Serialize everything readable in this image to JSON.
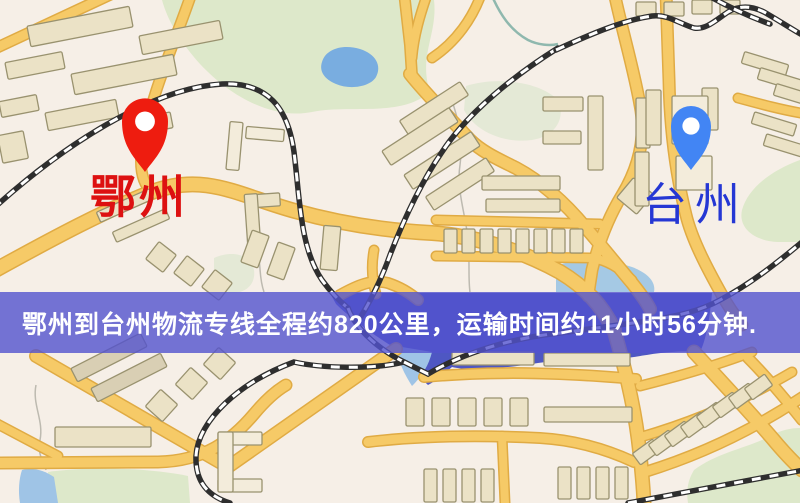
{
  "banner": {
    "text": "鄂州到台州物流专线全程约820公里，运输时间约11小时56分钟.",
    "bg": "rgba(82,82,206,0.8)",
    "text_color": "#ffffff",
    "top": 292,
    "height": 61
  },
  "origin": {
    "name": "鄂州",
    "pin_color": "#ee1c0f",
    "label_color": "#dd1111",
    "pin_x": 145,
    "pin_tip_y": 172,
    "pin_r": 23,
    "label_left": 90,
    "label_top": 174,
    "font_size": 46,
    "font_weight": 700,
    "letter_spacing": 3
  },
  "destination": {
    "name": "台州",
    "pin_color": "#4285f4",
    "label_color": "#2537d4",
    "pin_x": 691,
    "pin_tip_y": 170,
    "pin_r": 20,
    "label_left": 642,
    "label_top": 182,
    "font_size": 45,
    "font_weight": 400,
    "letter_spacing": 8
  },
  "map": {
    "width": 800,
    "height": 503,
    "bg": "#f6efe7",
    "palette": {
      "park": "#dde8ca",
      "park_muted": "#e4e9d6",
      "pond": "#79ade0",
      "lake": "#4e57c3",
      "water_light": "#9fc4e6",
      "water_pale": "#a5c9e4",
      "road_casing": "#e0ab44",
      "road_fill": "#f6ca67",
      "rail": "#2e2e2e",
      "rail_dash": "#ffffff",
      "bld": "#ebe2c6",
      "bld_stroke": "#99926f",
      "lt": "#f3ecdb",
      "hatch": "#d9cfb4",
      "stream": "#bdbab0",
      "stream_teal": "#8fb8ae"
    },
    "parks": [
      {
        "d": "M162,0 L434,0 C438,34 418,56 430,92 C400,118 350,104 312,112 C272,120 230,96 200,64 C182,44 168,22 162,0 Z",
        "f": "park"
      },
      {
        "d": "M800,160 C772,170 748,188 742,210 C738,228 754,241 778,242 L800,242 Z",
        "f": "park"
      },
      {
        "d": "M694,470 C718,452 748,448 770,436 C781,430 791,428 800,428 L800,503 L688,503 C686,490 688,480 694,470 Z",
        "f": "park"
      },
      {
        "d": "M48,472 C90,466 150,468 188,476 L190,503 L50,503 Z",
        "f": "park"
      },
      {
        "d": "M466,86 C498,76 540,82 558,100 C566,118 556,136 532,140 C502,144 474,130 464,110 Z",
        "f": "park_muted"
      },
      {
        "d": "M214,258 C232,250 250,254 254,270 C256,284 246,293 232,293 L214,293 Z",
        "f": "park_muted"
      }
    ],
    "water": [
      {
        "d": "M322,62 C326,48 344,44 360,49 C376,54 382,66 376,77 C370,87 350,90 336,84 C324,79 319,71 322,62 Z",
        "f": "pond"
      },
      {
        "d": "M330,293 L712,293 C710,318 706,340 700,352 C670,350 648,355 634,357 C598,362 564,359 538,363 C500,369 468,371 452,367 C444,374 436,381 428,385 C416,374 404,360 398,350 C378,338 350,318 336,304 Z",
        "f": "lake"
      },
      {
        "d": "M396,346 L432,352 C428,368 420,378 412,386 C403,372 397,358 396,346 Z",
        "f": "water_light"
      },
      {
        "d": "M22,470 C32,467 44,470 54,477 L58,503 L20,503 C18,491 19,479 22,470 Z",
        "f": "water_light"
      },
      {
        "d": "M556,266 C578,257 608,259 632,267 C648,273 656,282 654,292 L556,292 Z",
        "f": "water_pale"
      }
    ],
    "streams": [
      {
        "d": "M450,94 C458,120 464,135 460,165 C456,190 466,215 468,240 C470,262 468,278 470,292",
        "c": "stream",
        "w": 1.5
      },
      {
        "d": "M256,250 C262,262 258,275 264,292",
        "c": "stream",
        "w": 1.5
      },
      {
        "d": "M36,385 C32,405 44,420 40,440 C37,455 44,462 46,470",
        "c": "stream",
        "w": 1.5
      },
      {
        "d": "M492,-4 C500,14 510,30 528,40 C538,45 550,46 558,44",
        "c": "stream_teal",
        "w": 2.5
      }
    ],
    "roads": [
      {
        "d": "M-8,50 L116,-8",
        "w": 9
      },
      {
        "d": "M192,-8 C176,40 150,95 142,148 C139,170 143,184 152,192",
        "w": 9
      },
      {
        "d": "M-10,273 C55,237 108,209 152,192 C205,172 240,196 295,211 C345,225 392,231 432,233 C475,236 520,250 560,272 C585,287 602,305 614,330",
        "w": 13
      },
      {
        "d": "M614,330 C624,365 633,400 638,438 C641,462 643,482 644,503",
        "w": 12
      },
      {
        "d": "M404,-8 L410,45 L412,76",
        "w": 9
      },
      {
        "d": "M428,-8 C420,15 414,35 412,58",
        "w": 8
      },
      {
        "d": "M482,-8 C473,18 456,42 432,58",
        "w": 8
      },
      {
        "d": "M410,74 C424,92 448,116 470,140 C482,152 500,160 516,168 C542,182 566,204 586,228 C600,244 616,264 632,283 C640,293 646,301 650,309",
        "w": 11
      },
      {
        "d": "M614,-8 C622,30 634,70 640,105 C646,135 640,165 622,195 C608,218 598,245 592,270 L588,296",
        "w": 10
      },
      {
        "d": "M666,-8 L669,80 C670,130 676,175 686,215 C692,240 708,270 722,295 C728,306 735,316 742,325",
        "w": 10
      },
      {
        "d": "M694,352 C720,380 748,410 772,438 C782,450 792,461 802,470",
        "w": 12
      },
      {
        "d": "M738,98 C760,104 782,110 806,114",
        "w": 8
      },
      {
        "d": "M424,377 C490,371 555,372 636,379",
        "w": 9
      },
      {
        "d": "M640,386 C688,374 720,364 752,352",
        "w": 8
      },
      {
        "d": "M641,437 C700,420 748,398 792,372",
        "w": 8
      },
      {
        "d": "M645,472 C710,452 762,424 804,396",
        "w": 9
      },
      {
        "d": "M368,442 C420,436 480,435 540,438 C575,440 608,450 634,462",
        "w": 9
      },
      {
        "d": "M36,356 L228,467 L396,349",
        "w": 11
      },
      {
        "d": "M-8,463 L158,462 C205,461 232,440 254,414 C264,402 274,392 286,385",
        "w": 10
      },
      {
        "d": "M-10,420 L58,456",
        "w": 8
      },
      {
        "d": "M502,436 L505,503",
        "w": 8
      },
      {
        "d": "M748,358 C768,378 786,400 802,420",
        "w": 9
      },
      {
        "d": "M340,295 C358,285 372,279 388,283 C400,287 410,293 418,300",
        "w": 9
      },
      {
        "d": "M374,250 C371,266 372,280 376,294",
        "w": 8
      },
      {
        "d": "M436,220 L600,224",
        "w": 8
      },
      {
        "d": "M436,256 L592,258 C606,260 620,268 632,280",
        "w": 8
      }
    ],
    "railways": [
      "M-6,208 C60,148 150,88 222,84 C268,82 288,108 294,152 C300,200 300,248 322,280 C330,291 338,300 348,308",
      "M558,48 C515,75 468,112 442,152 C420,184 402,224 390,255 C380,283 368,305 360,318",
      "M348,308 C356,330 380,350 404,362 C372,370 320,368 294,362 C240,382 198,420 196,456 C195,482 208,496 230,503",
      "M404,362 C412,366 420,370 428,374 C465,352 512,338 560,333 L640,322 C680,316 702,310 720,300 C752,283 778,262 802,242",
      "M556,50 C595,32 625,20 652,16 C668,14 680,24 694,28 C706,30 716,20 728,12 C740,5 752,6 764,12 C778,20 790,28 804,36",
      "M702,-8 C726,6 748,16 770,24",
      "M628,503 L804,470"
    ],
    "buildings": [
      [
        28,
        16,
        104,
        21,
        -11
      ],
      [
        140,
        28,
        82,
        19,
        -11
      ],
      [
        6,
        57,
        58,
        17,
        -11
      ],
      [
        72,
        64,
        104,
        21,
        -11
      ],
      [
        0,
        98,
        38,
        16,
        -11
      ],
      [
        46,
        106,
        72,
        18,
        -11
      ],
      [
        128,
        116,
        44,
        16,
        -11
      ],
      [
        0,
        133,
        26,
        28,
        -11
      ],
      [
        96,
        200,
        58,
        11,
        -24
      ],
      [
        112,
        220,
        58,
        11,
        -24
      ],
      [
        150,
        246,
        22,
        22,
        38
      ],
      [
        178,
        260,
        22,
        22,
        38
      ],
      [
        206,
        274,
        22,
        22,
        38
      ],
      [
        228,
        122,
        13,
        48,
        5,
        "lt"
      ],
      [
        246,
        128,
        38,
        12,
        5,
        "lt"
      ],
      [
        246,
        194,
        34,
        13,
        -4
      ],
      [
        246,
        194,
        13,
        52,
        -4
      ],
      [
        398,
        100,
        72,
        16,
        -33
      ],
      [
        380,
        128,
        80,
        17,
        -33
      ],
      [
        402,
        152,
        80,
        17,
        -33
      ],
      [
        424,
        176,
        72,
        16,
        -33
      ],
      [
        322,
        226,
        17,
        44,
        5
      ],
      [
        246,
        232,
        18,
        34,
        20
      ],
      [
        272,
        244,
        18,
        34,
        20
      ],
      [
        622,
        183,
        26,
        26,
        40
      ],
      [
        543,
        97,
        40,
        14,
        0
      ],
      [
        543,
        131,
        38,
        13,
        0
      ],
      [
        588,
        96,
        15,
        74,
        0
      ],
      [
        636,
        98,
        14,
        50,
        0
      ],
      [
        635,
        152,
        14,
        54,
        0
      ],
      [
        646,
        90,
        15,
        55,
        0
      ],
      [
        702,
        88,
        16,
        42,
        0
      ],
      [
        672,
        96,
        36,
        48,
        0,
        "lt"
      ],
      [
        676,
        156,
        36,
        34,
        0,
        "lt"
      ],
      [
        482,
        176,
        78,
        14,
        0
      ],
      [
        486,
        199,
        74,
        13,
        0
      ],
      [
        444,
        229,
        13,
        24,
        0
      ],
      [
        462,
        229,
        13,
        24,
        0
      ],
      [
        480,
        229,
        13,
        24,
        0
      ],
      [
        498,
        229,
        13,
        24,
        0
      ],
      [
        516,
        229,
        13,
        24,
        0
      ],
      [
        534,
        229,
        13,
        24,
        0
      ],
      [
        552,
        229,
        13,
        24,
        0
      ],
      [
        570,
        229,
        13,
        24,
        0
      ],
      [
        636,
        2,
        20,
        14,
        0
      ],
      [
        664,
        2,
        20,
        14,
        0
      ],
      [
        692,
        0,
        20,
        14,
        0
      ],
      [
        720,
        0,
        20,
        14,
        0
      ],
      [
        742,
        58,
        46,
        12,
        17
      ],
      [
        758,
        74,
        46,
        12,
        17
      ],
      [
        774,
        90,
        46,
        12,
        17
      ],
      [
        752,
        118,
        44,
        12,
        17
      ],
      [
        764,
        140,
        44,
        12,
        17
      ],
      [
        70,
        350,
        78,
        15,
        -27,
        "hatch"
      ],
      [
        90,
        370,
        78,
        15,
        -27,
        "hatch"
      ],
      [
        150,
        394,
        23,
        23,
        42
      ],
      [
        180,
        372,
        23,
        23,
        42
      ],
      [
        208,
        352,
        23,
        23,
        42
      ],
      [
        55,
        427,
        96,
        20,
        0
      ],
      [
        218,
        432,
        44,
        13,
        0,
        "lt"
      ],
      [
        218,
        479,
        44,
        13,
        0,
        "lt"
      ],
      [
        218,
        432,
        15,
        60,
        0,
        "lt"
      ],
      [
        452,
        352,
        82,
        13,
        0
      ],
      [
        544,
        353,
        86,
        13,
        0
      ],
      [
        406,
        398,
        18,
        28,
        0
      ],
      [
        432,
        398,
        18,
        28,
        0
      ],
      [
        458,
        398,
        18,
        28,
        0
      ],
      [
        484,
        398,
        18,
        28,
        0
      ],
      [
        510,
        398,
        18,
        28,
        0
      ],
      [
        544,
        407,
        88,
        15,
        0
      ],
      [
        424,
        469,
        13,
        33,
        0
      ],
      [
        443,
        469,
        13,
        33,
        0
      ],
      [
        462,
        469,
        13,
        33,
        0
      ],
      [
        481,
        469,
        13,
        33,
        0
      ],
      [
        558,
        467,
        13,
        32,
        0
      ],
      [
        577,
        467,
        13,
        32,
        0
      ],
      [
        596,
        467,
        13,
        32,
        0
      ],
      [
        615,
        467,
        13,
        32,
        0
      ],
      [
        634,
        445,
        25,
        14,
        -36
      ],
      [
        650,
        436,
        25,
        14,
        -36
      ],
      [
        666,
        427,
        25,
        14,
        -36
      ],
      [
        682,
        418,
        25,
        14,
        -36
      ],
      [
        698,
        408,
        25,
        14,
        -36
      ],
      [
        714,
        398,
        25,
        14,
        -36
      ],
      [
        730,
        389,
        25,
        14,
        -36
      ],
      [
        746,
        380,
        25,
        14,
        -36
      ]
    ]
  }
}
